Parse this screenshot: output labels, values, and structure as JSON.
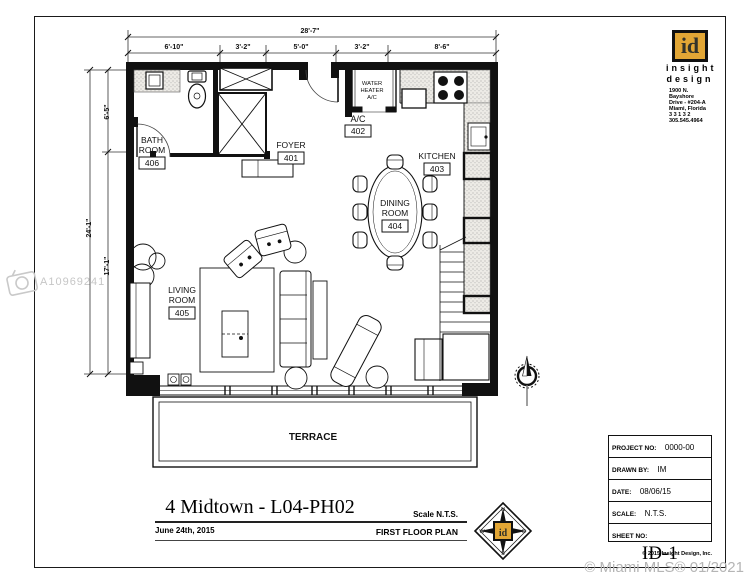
{
  "page": {
    "watermark_id": "A10969241",
    "watermark_mls": "© Miami MLS® 01/2021"
  },
  "logo": {
    "initials": "id",
    "word1": "insight",
    "word2": "design",
    "address_line1": "1900 N. Bayshore",
    "address_line2": "Drive - #204-A",
    "address_line3": "Miami, Florida",
    "address_line4": "3 3 1 3 2",
    "address_line5": "305.545.4964"
  },
  "titlebar": {
    "title": "4 Midtown - L04-PH02",
    "date": "June 24th, 2015",
    "scale": "Scale N.T.S.",
    "plan_name": "FIRST FLOOR PLAN"
  },
  "titleblock": {
    "project_label": "PROJECT NO:",
    "project_value": "0000-00",
    "drawn_label": "DRAWN BY:",
    "drawn_value": "IM",
    "date_label": "DATE:",
    "date_value": "08/06/15",
    "scale_label": "SCALE:",
    "scale_value": "N.T.S.",
    "sheet_label": "SHEET NO:",
    "sheet_value": "ID-1",
    "copyright": "© 2015 Insight Design, Inc."
  },
  "plan": {
    "rooms": {
      "bath": {
        "name_line1": "BATH",
        "name_line2": "ROOM",
        "number": "406"
      },
      "foyer": {
        "name": "FOYER",
        "number": "401"
      },
      "ac": {
        "name": "A/C",
        "number": "402"
      },
      "kitchen": {
        "name": "KITCHEN",
        "number": "403"
      },
      "dining": {
        "name_line1": "DINING",
        "name_line2": "ROOM",
        "number": "404"
      },
      "living": {
        "name_line1": "LIVING",
        "name_line2": "ROOM",
        "number": "405"
      },
      "terrace": {
        "name": "TERRACE"
      },
      "water_heater": {
        "line1": "WATER",
        "line2": "HEATER",
        "line3": "A/C"
      }
    },
    "dims": {
      "top_total": "28'-7\"",
      "seg1": "6'-10\"",
      "seg2": "3'-2\"",
      "seg3": "5'-0\"",
      "seg4": "3'-2\"",
      "seg5": "8'-6\"",
      "left_total": "24'-1\"",
      "left_upper": "6'-5\"",
      "left_lower": "17'-1\""
    }
  },
  "compass": {
    "n": "N",
    "e": "E",
    "s": "S",
    "w": "W"
  }
}
